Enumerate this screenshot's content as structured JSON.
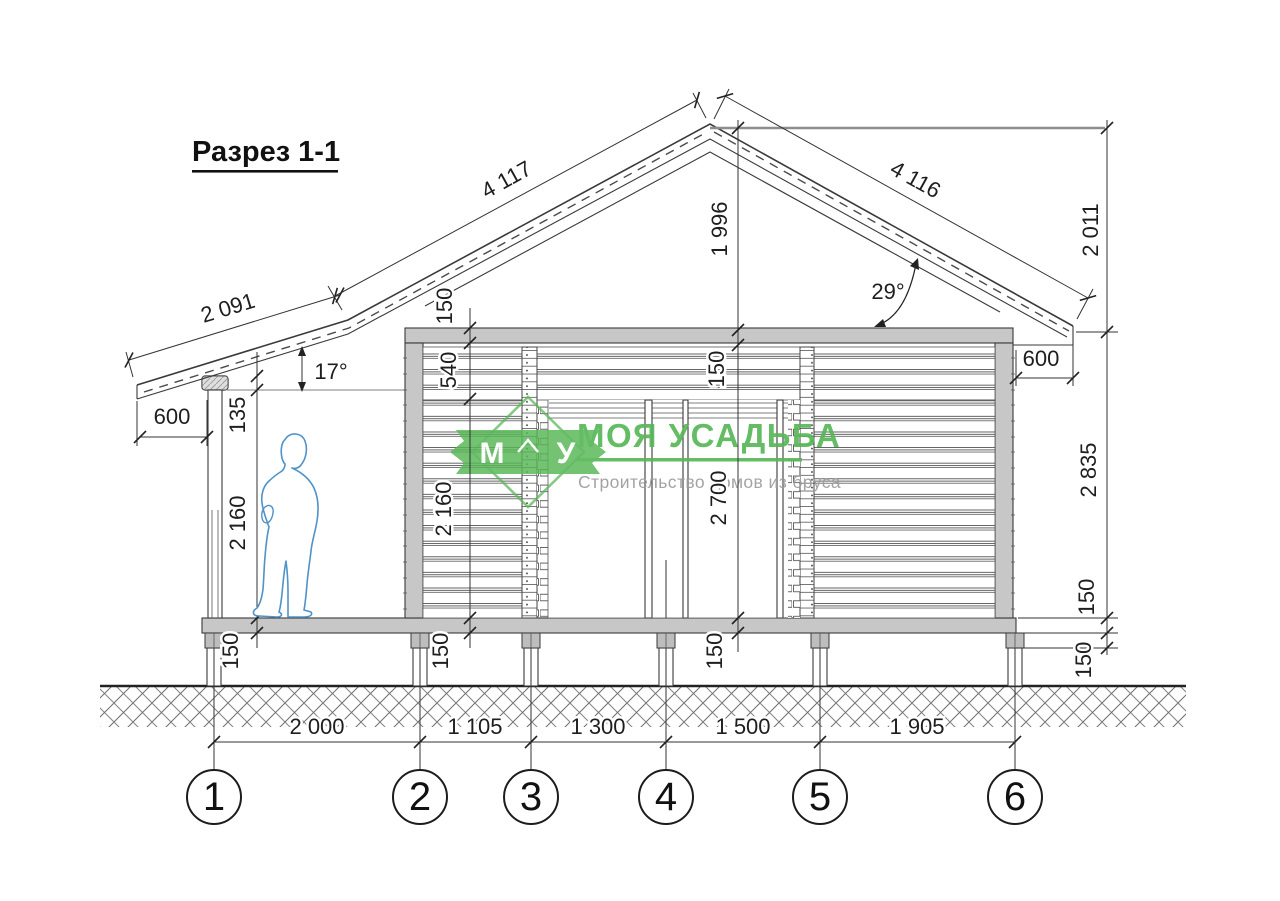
{
  "title": "Разрез 1-1",
  "drawing": {
    "type": "house-cross-section",
    "angles": {
      "porch_roof": "17°",
      "main_roof": "29°"
    },
    "dims": {
      "roof_left_slope": "4 117",
      "roof_right_slope": "4 116",
      "porch_roof_slope": "2 091",
      "ridge_to_wall_top": "1 996",
      "ridge_to_eave_right": "2 011",
      "wall_height_right": "2 835",
      "eave_overhang_left": "600",
      "eave_overhang_right": "600",
      "porch_chain": {
        "roof_gap": "135",
        "clear_height": "2 160",
        "floor": "150"
      },
      "wall_chain": {
        "top_plate": "150",
        "above_opening": "540",
        "opening_height": "2 160",
        "floor": "150"
      },
      "center_chain": {
        "ceiling": "150",
        "clear_height": "2 700",
        "floor": "150"
      },
      "right_chain": {
        "floor": "150",
        "pier": "150"
      },
      "bottom_spans": [
        "2 000",
        "1 105",
        "1 300",
        "1 500",
        "1 905"
      ]
    },
    "axes": [
      "1",
      "2",
      "3",
      "4",
      "5",
      "6"
    ]
  },
  "logo": {
    "monogram_left": "М",
    "monogram_right": "У",
    "name": "МОЯ УСАДЬБА",
    "tagline": "Строительство домов из бруса"
  },
  "colors": {
    "line": "#3a3a3a",
    "fill_gray": "#c7c7c7",
    "logo_green": "#57b757",
    "tagline_gray": "#9c9c9c",
    "figure_blue": "#4f93c8"
  }
}
